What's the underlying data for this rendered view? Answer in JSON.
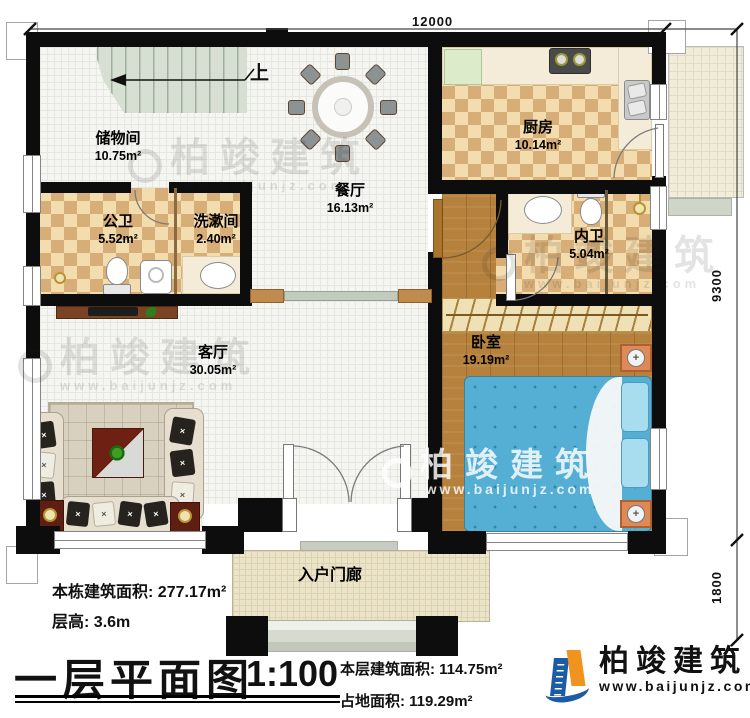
{
  "dims": {
    "top": "12000",
    "right_upper": "9300",
    "right_lower": "1800"
  },
  "stairs": {
    "up": "上"
  },
  "rooms": {
    "storage": {
      "name": "储物间",
      "area": "10.75m²"
    },
    "public_bath": {
      "name": "公卫",
      "area": "5.52m²"
    },
    "washroom": {
      "name": "洗漱间",
      "area": "2.40m²"
    },
    "dining": {
      "name": "餐厅",
      "area": "16.13m²"
    },
    "kitchen": {
      "name": "厨房",
      "area": "10.14m²"
    },
    "inner_bath": {
      "name": "内卫",
      "area": "5.04m²"
    },
    "bedroom": {
      "name": "卧室",
      "area": "19.19m²"
    },
    "living": {
      "name": "客厅",
      "area": "30.05m²"
    },
    "porch": {
      "name": "入户门廊"
    }
  },
  "info": {
    "building_area_label": "本栋建筑面积:",
    "building_area_value": "277.17m²",
    "floor_height_label": "层高:",
    "floor_height_value": "3.6m",
    "this_floor_area_label": "本层建筑面积:",
    "this_floor_area_value": "114.75m²",
    "footprint_label": "占地面积:",
    "footprint_value": "119.29m²"
  },
  "title": {
    "text": "一层平面图",
    "scale": "1:100"
  },
  "brand": {
    "name": "柏竣建筑",
    "website": "www.baijunjz.com"
  },
  "watermark": {
    "name": "柏竣建筑",
    "website": "www.baijunjz.com"
  },
  "colors": {
    "wall": "#0d0d0d",
    "wood": "#b5813d",
    "checker_dark": "#d8ae78",
    "bed_blue": "#55aed3",
    "logo_blue": "#1c5ca6",
    "logo_orange": "#f0941f"
  }
}
